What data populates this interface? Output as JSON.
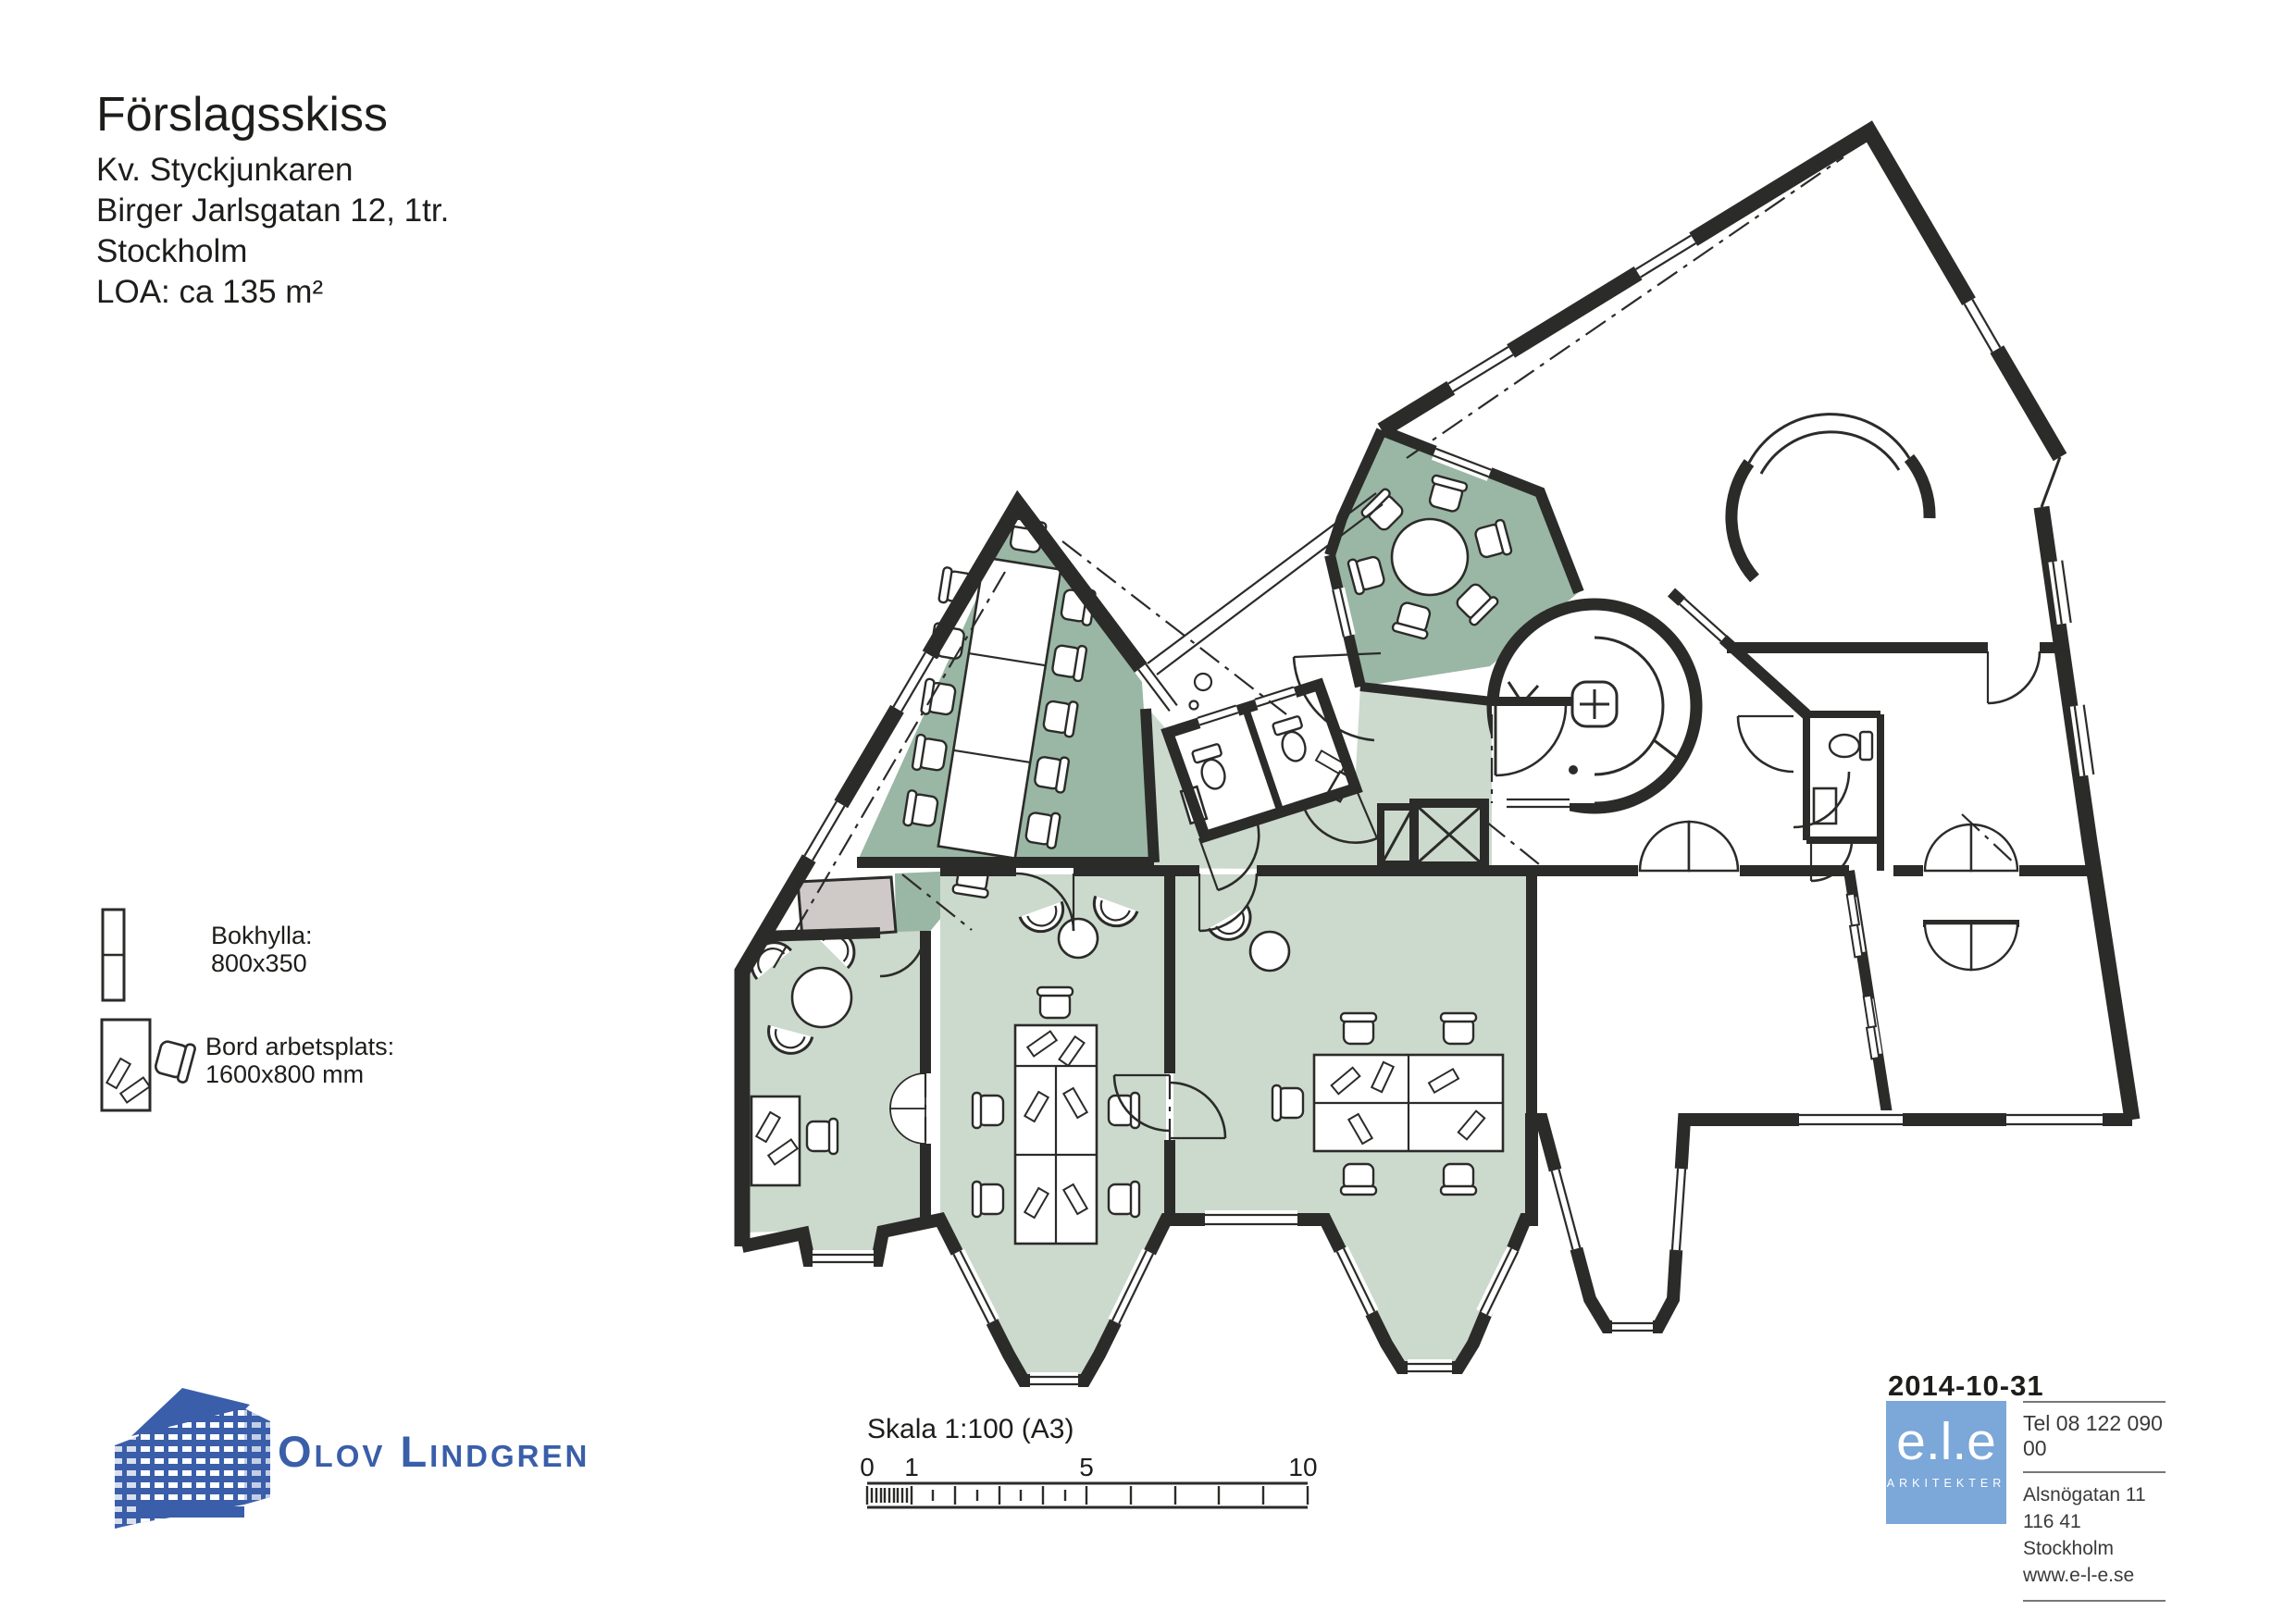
{
  "title_block": {
    "title": "Förslagsskiss",
    "lines": [
      "Kv. Styckjunkaren",
      "Birger Jarlsgatan 12, 1tr.",
      "Stockholm",
      "LOA: ca 135 m²"
    ]
  },
  "legend": {
    "items": [
      {
        "icon": "bookshelf-icon",
        "label": "Bokhylla:",
        "dims": "800x350"
      },
      {
        "icon": "desk-workplace-icon",
        "label": "Bord arbetsplats:",
        "dims": "1600x800 mm"
      }
    ]
  },
  "scalebar": {
    "label": "Skala 1:100 (A3)",
    "ticks": [
      "0",
      "1",
      "5",
      "10"
    ]
  },
  "footer": {
    "olov_lindgren": "Olov Lindgren",
    "date": "2014-10-31",
    "ele": {
      "name": "e.l.e",
      "sub": "ARKITEKTER"
    },
    "contact": {
      "tel": "Tel 08 122 090 00",
      "address1": "Alsnögatan 11",
      "address2": "116 41 Stockholm",
      "web": "www.e-l-e.se"
    }
  },
  "colors": {
    "wall": "#2b2b29",
    "dark_green": "#9ab6a4",
    "light_green": "#ccd9cd",
    "wc_blue": "#a9c8e2",
    "gray": "#cfc9c8",
    "logo_blue": "#3a5ea9",
    "ele_blue": "#7ba7d9"
  }
}
